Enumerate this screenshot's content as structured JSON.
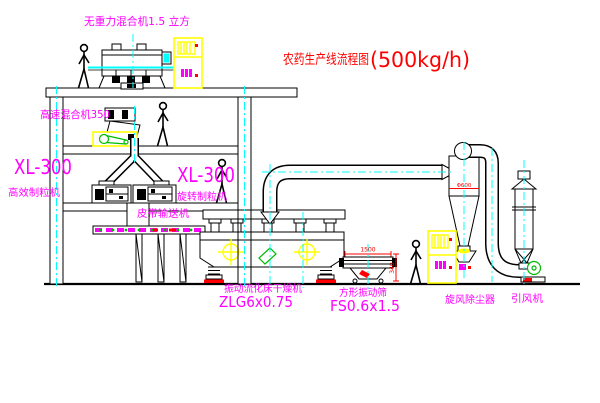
{
  "title": {
    "main": "农药生产线流程图",
    "capacity": "(500kg/h)"
  },
  "labels": {
    "gravity_mixer": "无重力混合机1.5 立方",
    "high_speed_mixer": "高速混合机350",
    "granulator_left_model": "XL-300",
    "granulator_left_name": "高效制粒机",
    "granulator_right_model": "XL-300",
    "granulator_right_name": "旋转制粒机",
    "belt_conveyor": "皮带输送机",
    "dryer_name": "振动流化床干燥机",
    "dryer_model": "ZLG6x0.75",
    "screen_name": "方形振动筛",
    "screen_model": "FS0.6x1.5",
    "cyclone": "旋风除尘器",
    "fan": "引风机"
  },
  "dimensions": {
    "cyclone_diameter": "Φ600",
    "screen_length": "1500",
    "screen_height": "340"
  },
  "colors": {
    "line": "#000000",
    "label_magenta": "#ff00ff",
    "title_red": "#ff0000",
    "centerline_cyan": "#00ffff",
    "cabinet_yellow": "#ffff00",
    "detail_green": "#00bb00",
    "background": "#ffffff"
  }
}
